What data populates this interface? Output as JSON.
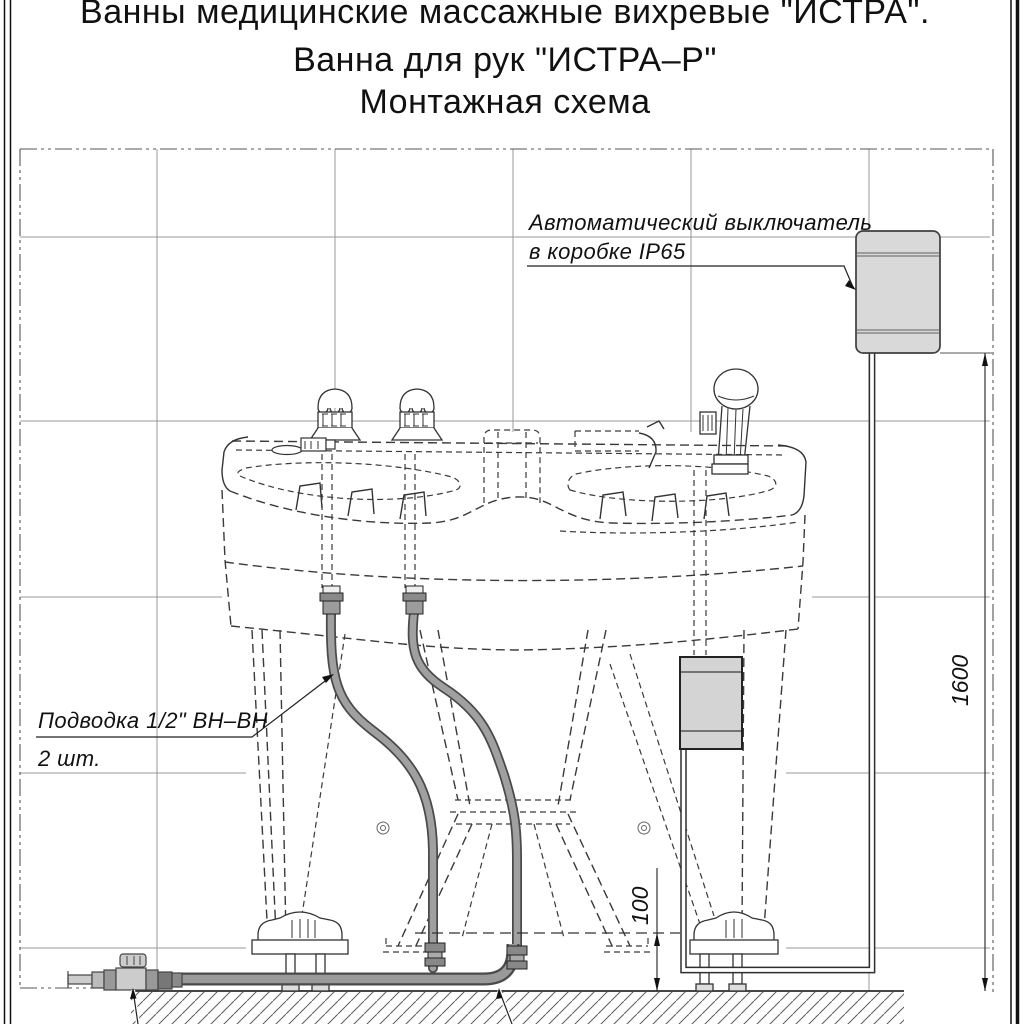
{
  "title": {
    "line1": "Ванны медицинские массажные вихревые \"ИСТРА\".",
    "line2": "Ванна для рук \"ИСТРА–Р\"",
    "line3": "Монтажная схема"
  },
  "annotations": {
    "breaker_label": {
      "line1": "Автоматический выключатель",
      "line2": "в коробке IP65"
    },
    "supply_label": {
      "line1": "Подводка 1/2\" ВН–ВН",
      "line2": "2 шт."
    }
  },
  "dimensions": {
    "breaker_height": "1600",
    "pipe_height": "100"
  },
  "colors": {
    "box_fill": "#d9d9d9",
    "hose_core": "#a0a0a0",
    "line": "#333333"
  }
}
